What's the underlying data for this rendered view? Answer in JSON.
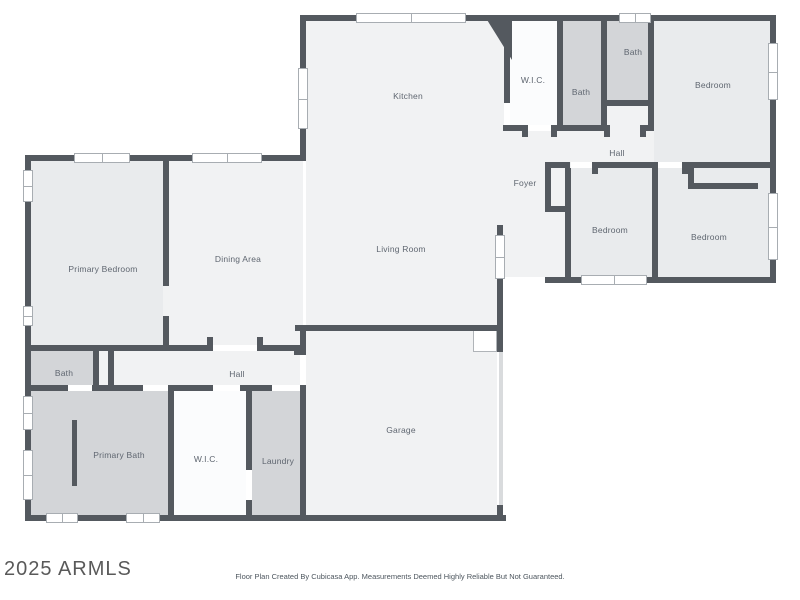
{
  "watermark": "2025 ARMLS",
  "footer": "Floor Plan Created By Cubicasa App. Measurements Deemed Highly Reliable But Not Guaranteed.",
  "colors": {
    "wall": "#54595f",
    "room": "#f1f2f3",
    "bedroom": "#e9ebed",
    "bath": "#d3d5d8",
    "closet": "#fbfcfd",
    "label": "#5f6670",
    "background": "#ffffff"
  },
  "rooms": {
    "kitchen": {
      "label": "Kitchen"
    },
    "wic_upper": {
      "label": "W.I.C."
    },
    "bath_upper_mid": {
      "label": "Bath"
    },
    "bath_upper_right": {
      "label": "Bath"
    },
    "bedroom_upper_right": {
      "label": "Bedroom"
    },
    "hall_upper": {
      "label": "Hall"
    },
    "foyer": {
      "label": "Foyer"
    },
    "living_room": {
      "label": "Living Room"
    },
    "bedroom_middle": {
      "label": "Bedroom"
    },
    "bedroom_right": {
      "label": "Bedroom"
    },
    "primary_bedroom": {
      "label": "Primary Bedroom"
    },
    "dining_area": {
      "label": "Dining Area"
    },
    "bath_lower": {
      "label": "Bath"
    },
    "hall_lower": {
      "label": "Hall"
    },
    "primary_bath": {
      "label": "Primary Bath"
    },
    "wic_lower": {
      "label": "W.I.C."
    },
    "laundry": {
      "label": "Laundry"
    },
    "garage": {
      "label": "Garage"
    }
  }
}
